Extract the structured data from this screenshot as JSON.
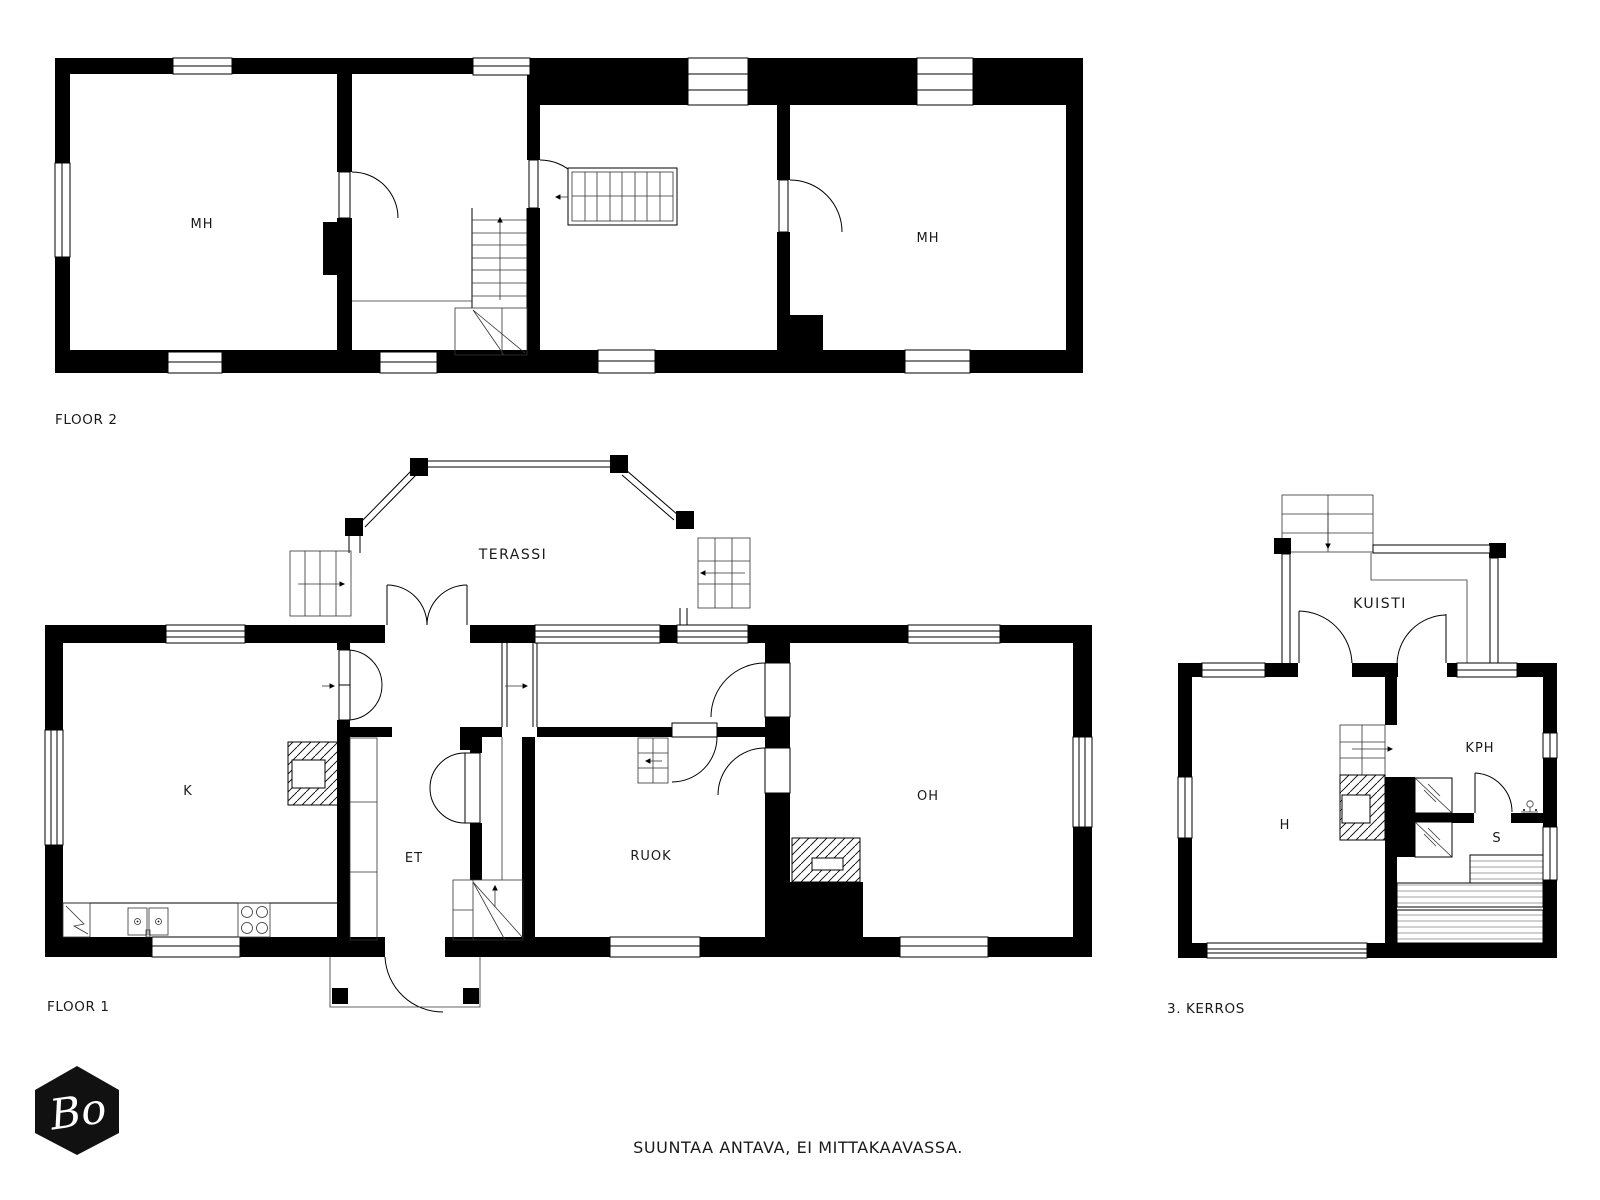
{
  "document": {
    "type": "floor-plan-sheet",
    "background": "#ffffff",
    "wall_color": "#000000",
    "line_color": "#1a1a1a"
  },
  "floor2": {
    "caption": "FLOOR 2",
    "room_left": "MH",
    "room_right": "MH"
  },
  "floor1": {
    "caption": "FLOOR 1",
    "terrace": "TERASSI",
    "kitchen": "K",
    "entry": "ET",
    "dining": "RUOK",
    "living": "OH"
  },
  "floor3": {
    "caption": "3. KERROS",
    "porch": "KUISTI",
    "hall": "H",
    "bathroom": "KPH",
    "sauna": "S"
  },
  "footer": {
    "disclaimer": "SUUNTAA ANTAVA, EI MITTAKAAVASSA."
  },
  "logo": {
    "text": "Bo",
    "shape": "hexagon",
    "color": "#111111"
  }
}
